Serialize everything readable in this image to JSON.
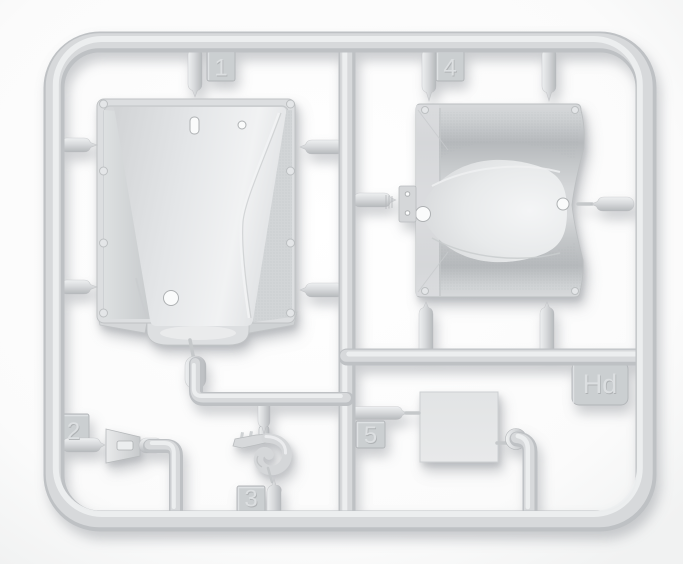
{
  "photo": {
    "subject": "plastic model kit sprue with molded parts",
    "background_color": "#fdfdfd",
    "plastic_color": "#d6d8da",
    "plastic_highlight": "#eef0f1",
    "plastic_shadow": "#b9bcbe",
    "tab_color": "#cbcfd1"
  },
  "tabs": {
    "t1": "1",
    "t2": "2",
    "t3": "3",
    "t4": "4",
    "t5": "5",
    "code": "Hd"
  }
}
